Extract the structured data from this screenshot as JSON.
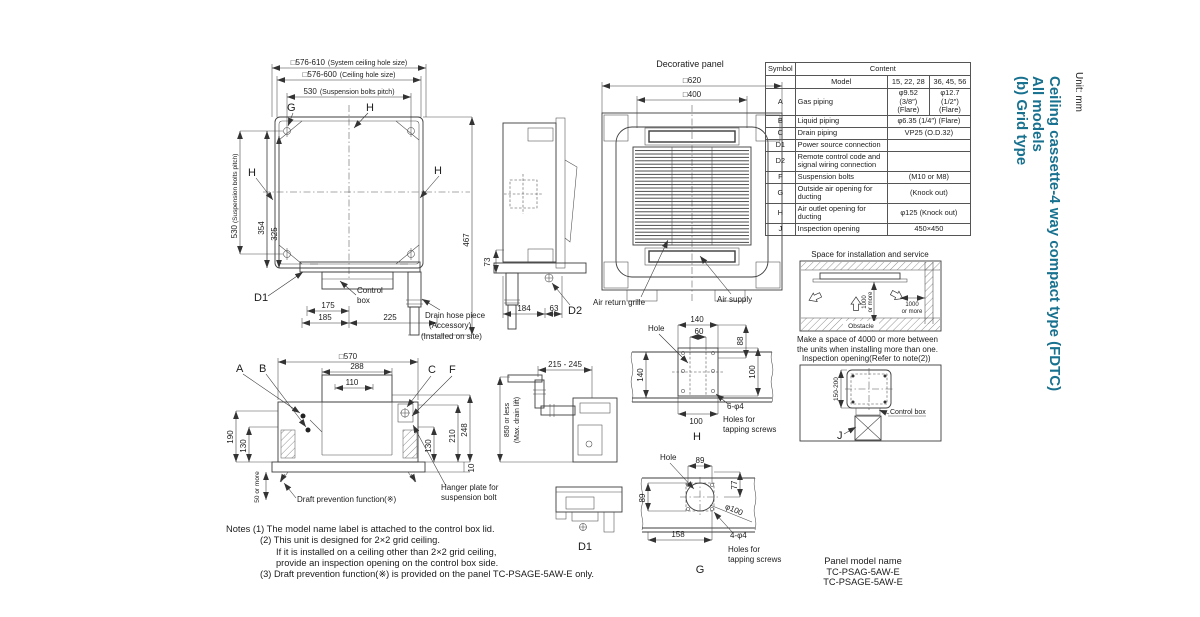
{
  "meta": {
    "accent": "#17718f"
  },
  "header": {
    "unit": "Unit: mm",
    "line1": "Ceiling cassette-4 way compact type (FDTC)",
    "line2": "All models",
    "line3": "(b) Grid type"
  },
  "plan": {
    "sys_hole": "□576-610",
    "sys_hole_note": "(System ceiling hole size)",
    "hole": "□576-600",
    "hole_note": "(Ceiling hole size)",
    "pitch": "530",
    "pitch_note": "(Suspension bolts pitch)",
    "pitch_v": "530",
    "pitch_v_note": "(Suspension bolts pitch)",
    "d354": "354",
    "d325": "325",
    "g": "G",
    "h": "H",
    "d1": "D1",
    "d175": "175",
    "d185": "185",
    "d225": "225",
    "control1": "Control",
    "control2": "box",
    "d467": "467",
    "drain1": "Drain hose piece",
    "drain2": "(Accessory)",
    "drain3": "(Installed on site)"
  },
  "side": {
    "d73": "73",
    "d184": "184",
    "d63": "63",
    "d2": "D2"
  },
  "panel": {
    "title": "Decorative panel",
    "d620": "□620",
    "d400": "□400",
    "air_return": "Air return grille",
    "air_supply": "Air supply"
  },
  "spec_table": {
    "symbol": "Symbol",
    "content": "Content",
    "model": "Model",
    "m1": "15, 22, 28",
    "m2": "36, 45, 56",
    "rows": [
      {
        "s": "A",
        "d": "Gas piping",
        "v1": "φ9.52 (3/8″)",
        "v1b": "(Flare)",
        "v2": "φ12.7 (1/2″)",
        "v2b": "(Flare)"
      },
      {
        "s": "B",
        "d": "Liquid piping",
        "v": "φ6.35 (1/4″) (Flare)"
      },
      {
        "s": "C",
        "d": "Drain piping",
        "v": "VP25 (O.D.32)"
      },
      {
        "s": "D1",
        "d": "Power source connection",
        "v": ""
      },
      {
        "s": "D2",
        "d": "Remote control code and signal wiring connection",
        "v": ""
      },
      {
        "s": "F",
        "d": "Suspension bolts",
        "v": "(M10 or M8)"
      },
      {
        "s": "G",
        "d": "Outside air opening for ducting",
        "v": "(Knock out)"
      },
      {
        "s": "H",
        "d": "Air outlet opening for ducting",
        "v": "φ125 (Knock out)"
      },
      {
        "s": "J",
        "d": "Inspection opening",
        "v": "450×450"
      }
    ]
  },
  "install": {
    "title": "Space for installation and service",
    "v1000a": "1000",
    "v1000b": "or more",
    "h1000a": "1000",
    "h1000b": "or more",
    "obstacle": "Obstacle",
    "cap1": "Make a space of 4000 or more between",
    "cap2": "the units when installing more than one."
  },
  "inspect": {
    "title": "Inspection opening(Refer to note(2))",
    "d150": "150-200",
    "control": "Control box",
    "j": "J"
  },
  "section": {
    "d570": "□570",
    "d288": "288",
    "d110": "110",
    "a": "A",
    "b": "B",
    "c": "C",
    "f": "F",
    "d190": "190",
    "d130l": "130",
    "d248": "248",
    "d210": "210",
    "d130r": "130",
    "d10": "10",
    "d50": "50 or more",
    "draft": "Draft prevention function(※)",
    "hanger1": "Hanger plate for",
    "hanger2": "suspension bolt"
  },
  "drain": {
    "d215": "215 - 245",
    "d850": "850 or less",
    "d850b": "(Max. drain lift)"
  },
  "hdet": {
    "hole": "Hole",
    "d140t": "140",
    "d60": "60",
    "d88": "88",
    "d140l": "140",
    "d100r": "100",
    "d100b": "100",
    "s1": "6-φ4",
    "s2": "Holes for",
    "s3": "tapping screws",
    "lbl": "H"
  },
  "gdet": {
    "hole": "Hole",
    "d89t": "89",
    "d77": "77",
    "d89l": "89",
    "d100": "φ100",
    "d158": "158",
    "s1": "4-φ4",
    "s2": "Holes for",
    "s3": "tapping screws",
    "lbl": "G"
  },
  "d1det": {
    "lbl": "D1"
  },
  "notes": {
    "l1": "Notes (1) The model name label is attached to the control box lid.",
    "l2": "(2) This unit is designed for 2×2 grid ceiling.",
    "l3": "If it is installed on a ceiling other than 2×2 grid ceiling,",
    "l4": "provide an inspection opening on the control box side.",
    "l5": "(3) Draft prevention function(※) is provided on the panel TC-PSAGE-5AW-E only."
  },
  "model": {
    "title": "Panel model name",
    "m1": "TC-PSAG-5AW-E",
    "m2": "TC-PSAGE-5AW-E"
  }
}
